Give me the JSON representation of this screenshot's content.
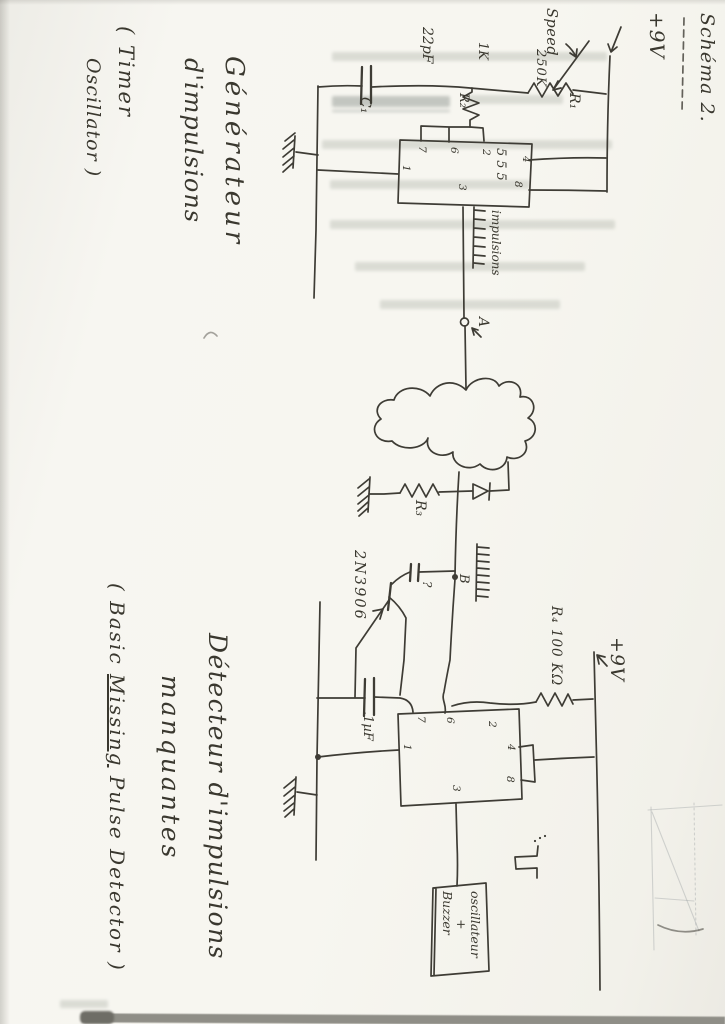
{
  "title": {
    "text": "Schéma 2."
  },
  "generator": {
    "heading": [
      "Générateur",
      "d'impulsions",
      "( Timer",
      "Oscillator )"
    ],
    "supply": "+9V",
    "speed": "Speed",
    "r1_value": "250K",
    "r1_name": "R₁",
    "r2_value": "1K",
    "r2_name": "R₂",
    "c1_value": "22pF",
    "c1_name": "C₁",
    "ic": "555",
    "pins": {
      "p7": "7",
      "p6": "6",
      "p2": "2",
      "p1": "1",
      "p4": "4",
      "p8": "8",
      "p3": "3"
    },
    "pulse_label": "impulsions",
    "node": "A"
  },
  "detector": {
    "heading": [
      "Détecteur d'impulsions",
      "manquantes"
    ],
    "subtitle": {
      "prefix": "( Basic ",
      "underlined": "Missing",
      "suffix": " Pulse Detector )"
    },
    "r3_name": "R₃",
    "transistor": "2N3906",
    "base_cap_note": "?",
    "node": "B",
    "r4_label": "R₄  100 KΩ",
    "supply": "+9V",
    "c2_value": ".1µF",
    "pins": {
      "p7": "7",
      "p6": "6",
      "p2": "2",
      "p1": "1",
      "p4": "4",
      "p8": "8",
      "p3": "3"
    },
    "output_box": [
      "oscillateur",
      "+",
      "Buzzer"
    ]
  }
}
